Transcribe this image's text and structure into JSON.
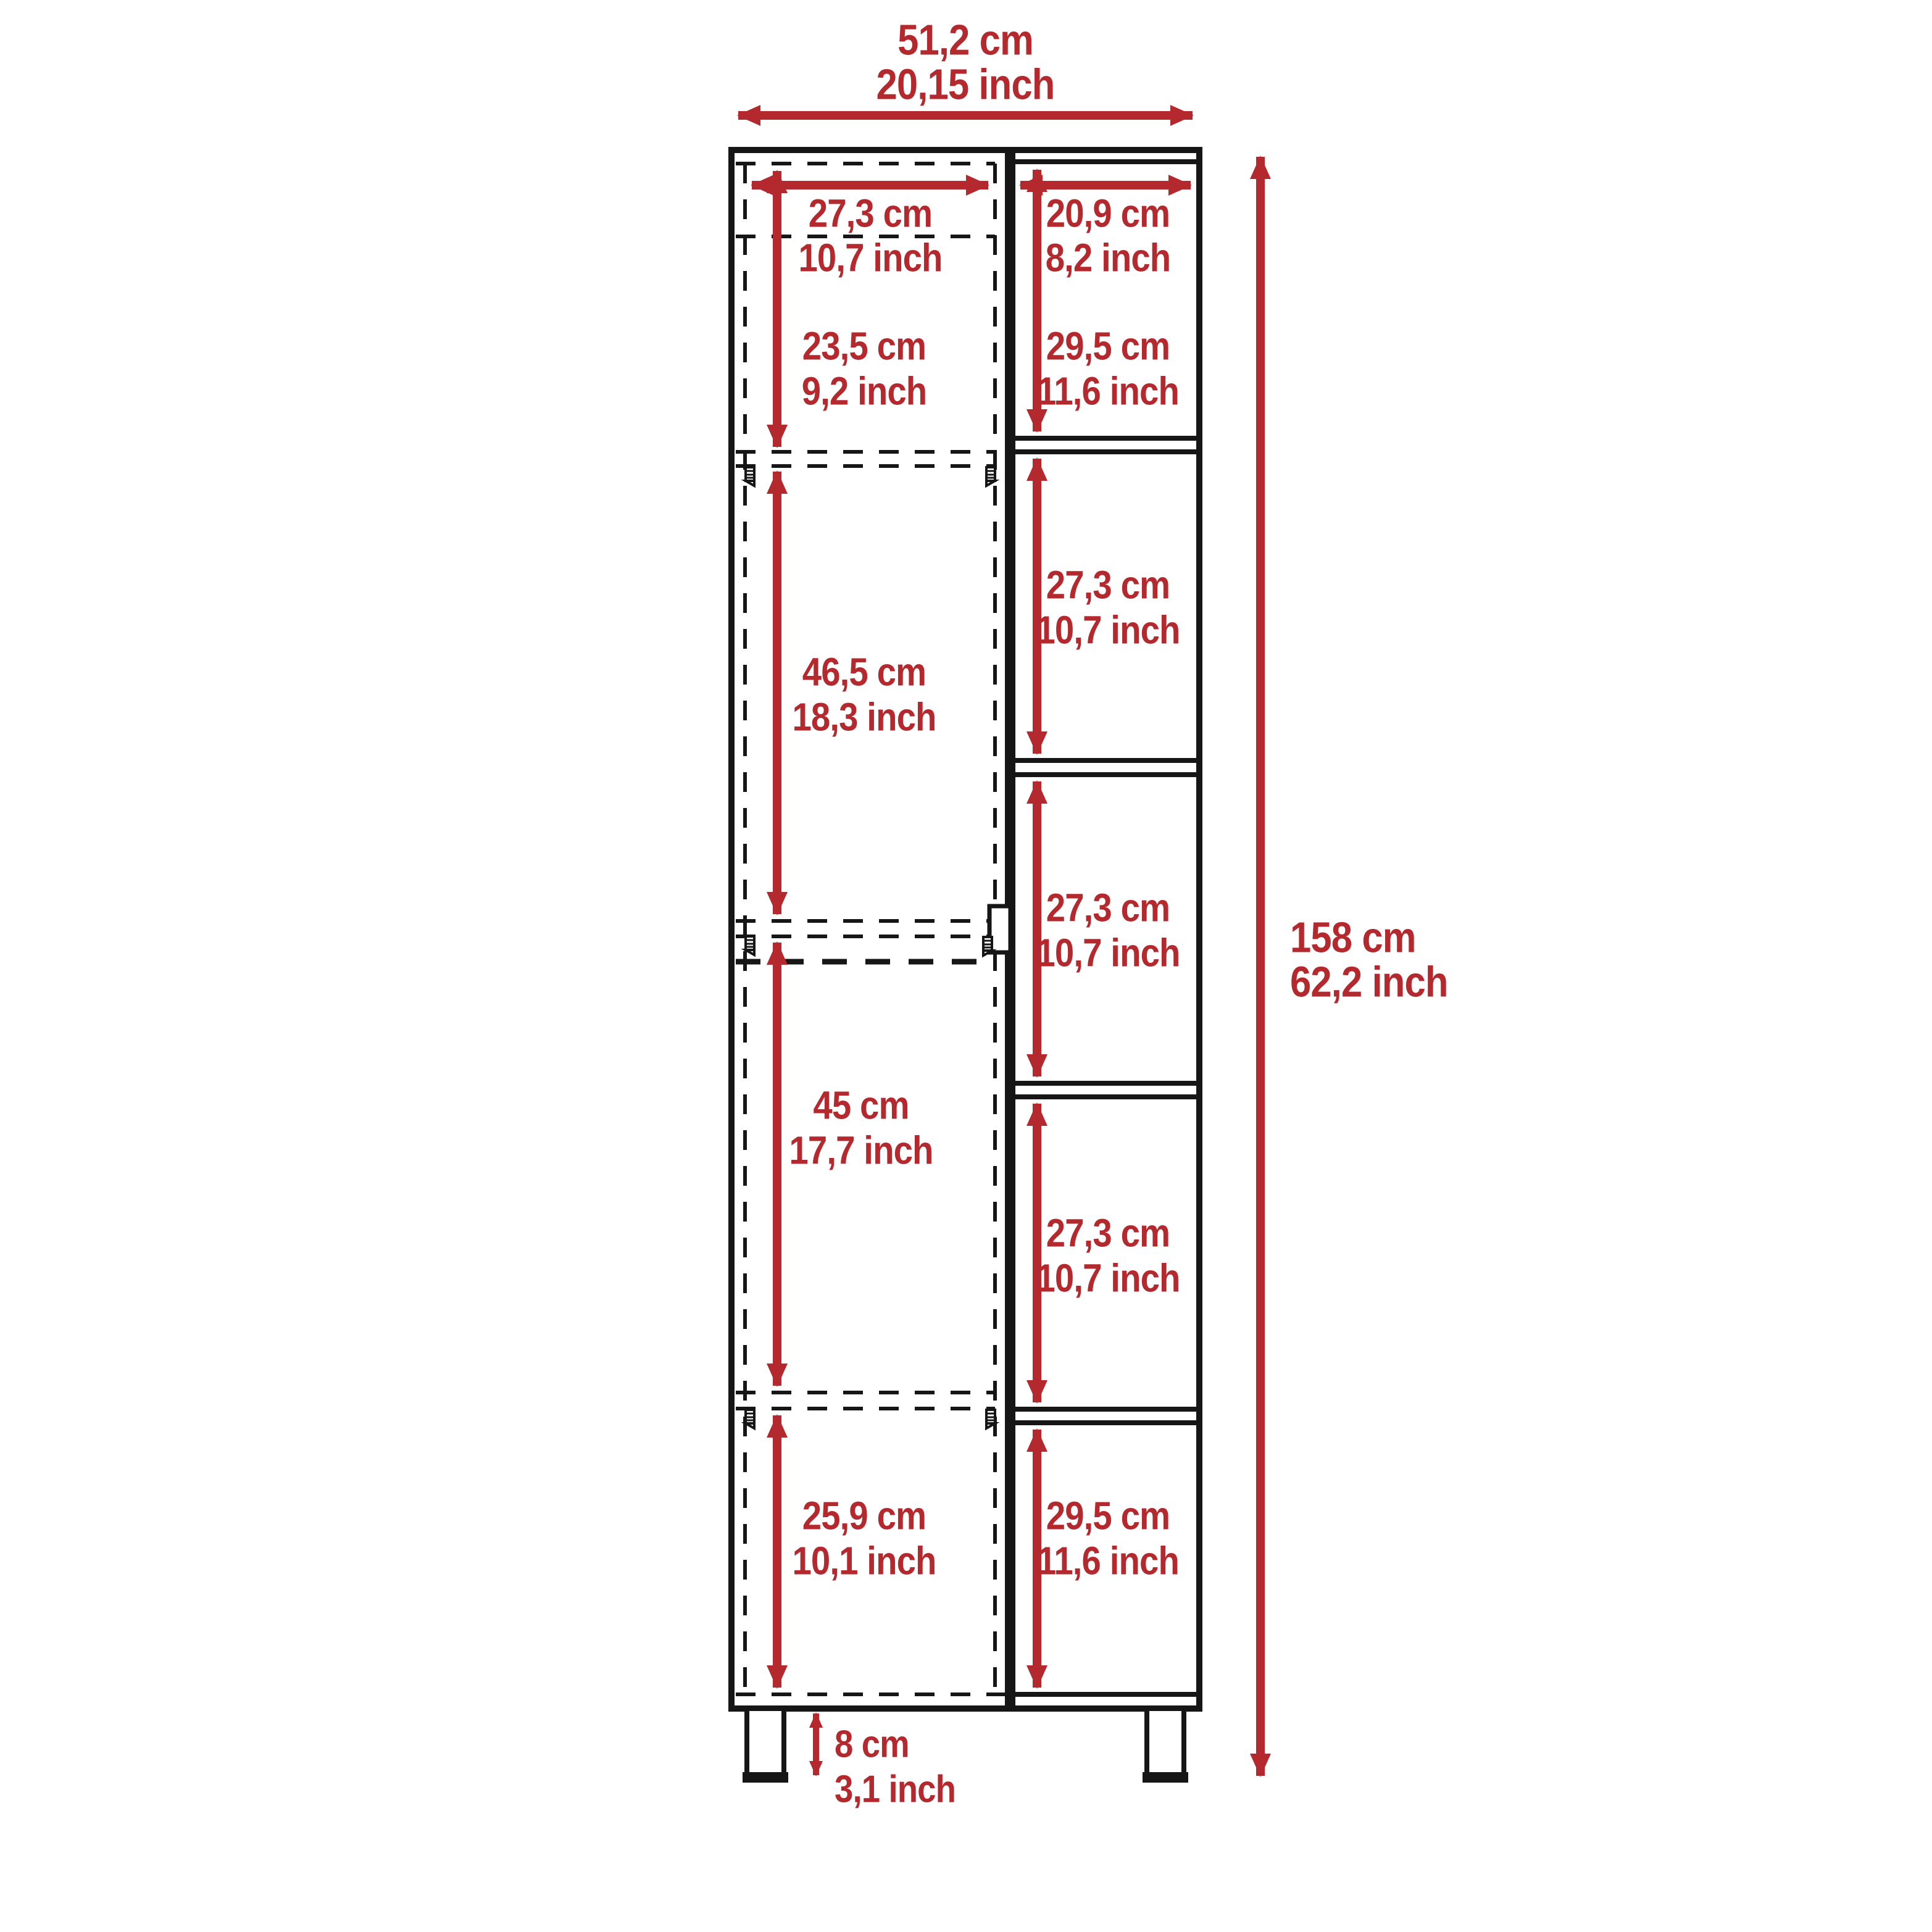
{
  "diagram": {
    "overall_width": {
      "cm": "51,2 cm",
      "inch": "20,15 inch"
    },
    "overall_height": {
      "cm": "158 cm",
      "inch": "62,2 inch"
    },
    "left_column": {
      "opening_width": {
        "cm": "27,3 cm",
        "inch": "10,7 inch"
      },
      "sections": [
        {
          "cm": "23,5 cm",
          "inch": "9,2 inch"
        },
        {
          "cm": "46,5 cm",
          "inch": "18,3 inch"
        },
        {
          "cm": "45 cm",
          "inch": "17,7 inch"
        },
        {
          "cm": "25,9 cm",
          "inch": "10,1 inch"
        }
      ]
    },
    "right_column": {
      "opening_width": {
        "cm": "20,9 cm",
        "inch": "8,2 inch"
      },
      "sections": [
        {
          "cm": "29,5 cm",
          "inch": "11,6 inch"
        },
        {
          "cm": "27,3 cm",
          "inch": "10,7 inch"
        },
        {
          "cm": "27,3 cm",
          "inch": "10,7 inch"
        },
        {
          "cm": "27,3 cm",
          "inch": "10,7 inch"
        },
        {
          "cm": "29,5 cm",
          "inch": "11,6 inch"
        }
      ]
    },
    "legs_height": {
      "cm": "8 cm",
      "inch": "3,1 inch"
    },
    "colors": {
      "dimension": "#b4292e",
      "outline": "#161616",
      "background": "#ffffff"
    }
  }
}
